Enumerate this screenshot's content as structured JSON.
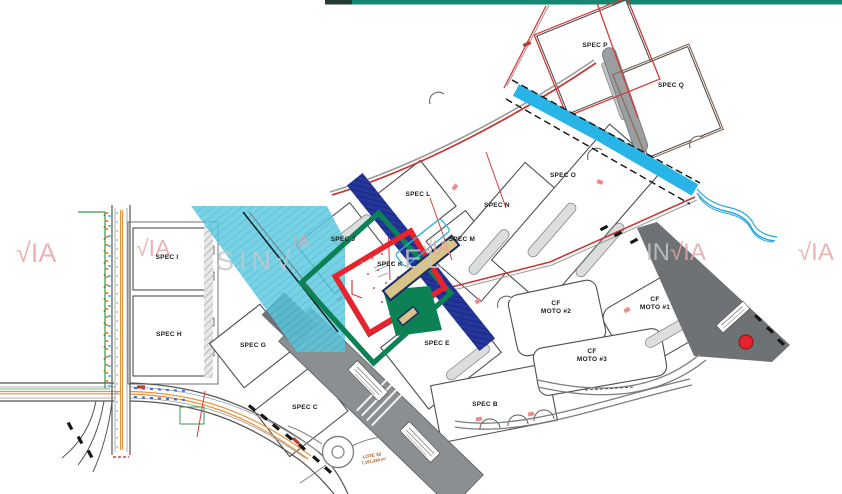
{
  "page": {
    "type": "industrial-park-site-plan"
  },
  "top_bars": {
    "dark_color": "#243b31",
    "teal_color": "#13876f"
  },
  "lots": [
    {
      "id": "spec-i",
      "label": "SPEC I"
    },
    {
      "id": "spec-h",
      "label": "SPEC H"
    },
    {
      "id": "spec-g",
      "label": "SPEC G"
    },
    {
      "id": "spec-c",
      "label": "SPEC C"
    },
    {
      "id": "spec-j",
      "label": "SPEC J"
    },
    {
      "id": "spec-k",
      "label": "SPEC K"
    },
    {
      "id": "spec-l",
      "label": "SPEC L"
    },
    {
      "id": "spec-m",
      "label": "SPEC M"
    },
    {
      "id": "spec-n",
      "label": "SPEC N"
    },
    {
      "id": "spec-o",
      "label": "SPEC O"
    },
    {
      "id": "spec-e",
      "label": "SPEC E"
    },
    {
      "id": "spec-b",
      "label": "SPEC B"
    },
    {
      "id": "spec-p",
      "label": "SPEC P"
    },
    {
      "id": "spec-q",
      "label": "SPEC Q"
    },
    {
      "id": "cf-moto-1",
      "line1": "CF",
      "line2": "MOTO #1"
    },
    {
      "id": "cf-moto-2",
      "line1": "CF",
      "line2": "MOTO #2"
    },
    {
      "id": "cf-moto-3",
      "line1": "CF",
      "line2": "MOTO #3"
    }
  ],
  "annotations": {
    "lote_line1": "LOTE 19",
    "lote_line2": "7,151,429 m²"
  },
  "watermark": {
    "check_ia": "√IA",
    "in": "IN",
    "sin_check": "SIN√",
    "el": "EL",
    "ia": "IA"
  },
  "highlight_colors": {
    "selection_red": "#e8232b",
    "selection_green": "#0c8154",
    "band_blue": "#24359c",
    "band_cyan": "#5ac8e0",
    "channel_cyan": "#29b4e8",
    "building_tan": "#d8c488",
    "road_gray": "#8b8f91",
    "dark_road_gray": "#6e7274",
    "boundary_red": "#d23c3c",
    "road_line_orange": "#e8923a"
  }
}
